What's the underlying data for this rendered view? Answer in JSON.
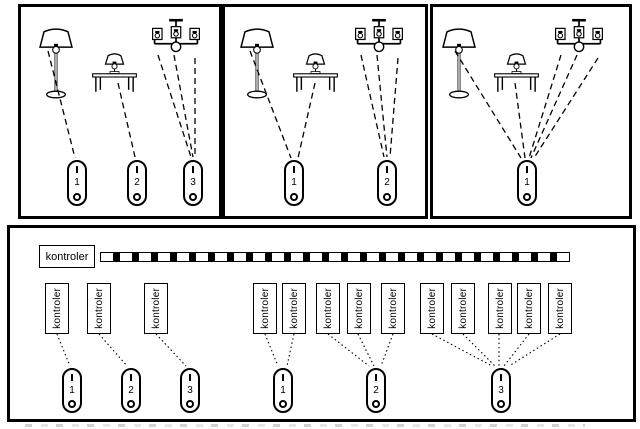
{
  "colors": {
    "ink": "#000000",
    "background": "#ffffff"
  },
  "top_panels": [
    {
      "name": "scenario-1",
      "lamps": [
        "floor-lamp",
        "table-lamp",
        "chandelier"
      ],
      "remotes": [
        {
          "label": "1"
        },
        {
          "label": "2"
        },
        {
          "label": "3"
        }
      ],
      "connections": [
        {
          "from": "floor-lamp",
          "to_remote": "1",
          "lines": 1
        },
        {
          "from": "table-lamp",
          "to_remote": "2",
          "lines": 1
        },
        {
          "from": "chandelier",
          "to_remote": "3",
          "lines": 3
        }
      ]
    },
    {
      "name": "scenario-2",
      "lamps": [
        "floor-lamp",
        "table-lamp",
        "chandelier"
      ],
      "remotes": [
        {
          "label": "1"
        },
        {
          "label": "2"
        }
      ],
      "connections": [
        {
          "from": "floor-lamp",
          "to_remote": "1",
          "lines": 1
        },
        {
          "from": "table-lamp",
          "to_remote": "1",
          "lines": 1
        },
        {
          "from": "chandelier",
          "to_remote": "2",
          "lines": 3
        }
      ]
    },
    {
      "name": "scenario-3",
      "lamps": [
        "floor-lamp",
        "table-lamp",
        "chandelier"
      ],
      "remotes": [
        {
          "label": "1"
        }
      ],
      "connections": [
        {
          "from": "floor-lamp",
          "to_remote": "1",
          "lines": 1
        },
        {
          "from": "table-lamp",
          "to_remote": "1",
          "lines": 1
        },
        {
          "from": "chandelier",
          "to_remote": "1",
          "lines": 3
        }
      ]
    }
  ],
  "bottom_panel": {
    "bus_controller": {
      "label": "kontroler"
    },
    "groups": [
      {
        "controllers": [
          "kontroler"
        ],
        "remote": {
          "label": "1"
        }
      },
      {
        "controllers": [
          "kontroler"
        ],
        "remote": {
          "label": "2"
        }
      },
      {
        "controllers": [
          "kontroler"
        ],
        "remote": {
          "label": "3"
        }
      },
      {
        "controllers": [
          "kontroler",
          "kontroler"
        ],
        "remote": {
          "label": "1"
        }
      },
      {
        "controllers": [
          "kontroler",
          "kontroler",
          "kontroler"
        ],
        "remote": {
          "label": "2"
        }
      },
      {
        "controllers": [
          "kontroler",
          "kontroler",
          "kontroler",
          "kontroler",
          "kontroler"
        ],
        "remote": {
          "label": "3"
        }
      }
    ]
  }
}
